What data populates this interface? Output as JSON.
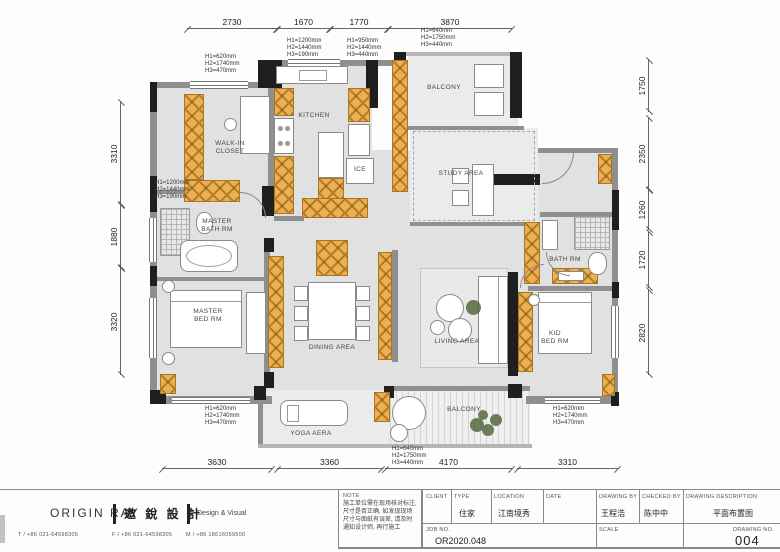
{
  "plan": {
    "rooms": {
      "walk_in_closet": "WALK-IN\nCLOSET",
      "kitchen": "KITCHEN",
      "ice": "ICE",
      "study_area": "STUDY AREA",
      "balcony_top": "BALCONY",
      "master_bath": "MASTER\nBATH RM",
      "master_bed": "MASTER\nBED RM",
      "dining": "DINING AREA",
      "living": "LIVING AREA",
      "yoga": "YOGA AERA",
      "balcony_bottom": "BALCONY",
      "kid_bed": "KID\nBED RM",
      "bath": "BATH RM"
    },
    "dims": {
      "top": [
        "2730",
        "1670",
        "1770",
        "3870"
      ],
      "bottom": [
        "3630",
        "3360",
        "4170",
        "3310"
      ],
      "left": [
        "3310",
        "1880",
        "3320"
      ],
      "right": [
        "1750",
        "2350",
        "1260",
        "1720",
        "2820"
      ]
    },
    "annotations": {
      "a1": "H1=620mm\nH2=1740mm\nH3=470mm",
      "a2": "H1=1200mm\nH2=1440mm\nH3=190mm",
      "a3": "H1=950mm\nH2=1440mm\nH3=440mm",
      "a4": "H1=640mm\nH2=1750mm\nH3=440mm",
      "a5": "H1=1200mm\nH2=1440mm\nH3=190mm",
      "a6": "H1=620mm\nH2=1740mm\nH3=470mm",
      "a7": "H1=640mm\nH2=1750mm\nH3=440mm",
      "a8": "H1=620mm\nH2=1740mm\nH3=470mm"
    },
    "colors": {
      "cabinet": "#edb04f",
      "wall": "#1f1f1f"
    }
  },
  "titleblock": {
    "logo": "ORIGIN RAY",
    "brand_cn": "邀 銳 設 計",
    "brand_sub": "Design  &  Visual",
    "tel": "T / +86 021-64598305",
    "fax": "F / +86 021-64598305",
    "mobile": "M / +86 18616059500",
    "note_label": "NOTE",
    "note_text": "施工单位需在现场核对标注,\n尺寸是否正确, 如发现现场\n尺寸与图纸有误差, 请及时\n通知设计师, 再行施工",
    "fields": {
      "client_label": "CLIENT",
      "client": "",
      "type_label": "TYPE",
      "type": "住家",
      "location_label": "LOCATION",
      "location": "江南境秀",
      "date_label": "DATE",
      "date": "",
      "drawing_by_label": "DRAWING BY",
      "drawing_by": "王程浩",
      "checked_by_label": "CHECKED BY",
      "checked_by": "陈中中",
      "description_label": "DRAWING DESCRIPTION",
      "description": "平面布置图",
      "job_no_label": "JOB NO.",
      "job_no": "OR2020.048",
      "scale_label": "SCALE",
      "scale": "",
      "drawing_no_label": "DRAWING NO.",
      "drawing_no": "004"
    }
  }
}
